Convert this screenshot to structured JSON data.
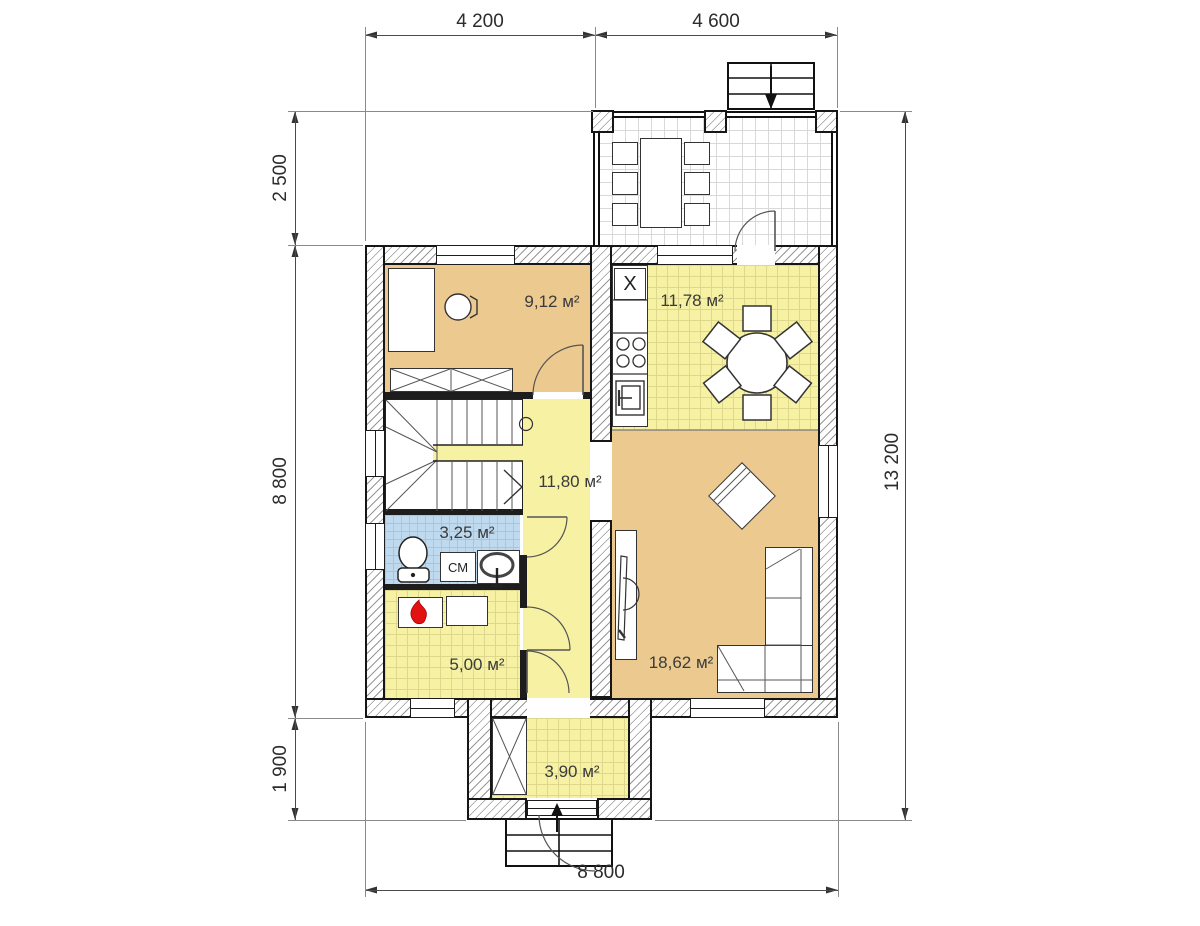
{
  "plan": {
    "dims": {
      "top": [
        {
          "label": "4 200"
        },
        {
          "label": "4 600"
        }
      ],
      "left": [
        {
          "label": "2 500"
        },
        {
          "label": "8 800"
        },
        {
          "label": "1 900"
        }
      ],
      "right": [
        {
          "label": "13 200"
        }
      ],
      "bottom": [
        {
          "label": "8 800"
        }
      ]
    },
    "rooms": {
      "study": {
        "area": "9,12 м²"
      },
      "kitchen": {
        "area": "11,78 м²"
      },
      "hall": {
        "area": "11,80 м²"
      },
      "bath": {
        "area": "3,25 м²"
      },
      "boiler": {
        "area": "5,00 м²"
      },
      "living": {
        "area": "18,62 м²"
      },
      "entry": {
        "area": "3,90 м²"
      }
    },
    "symbols": {
      "sink": "X",
      "washer": "СМ"
    },
    "colors": {
      "floor_warm": "#ecc98f",
      "floor_tile_yellow": "#f6f1a3",
      "floor_tile_blue": "#bfd9ee",
      "flame_red": "#e01212",
      "wall_line": "#161616"
    }
  }
}
